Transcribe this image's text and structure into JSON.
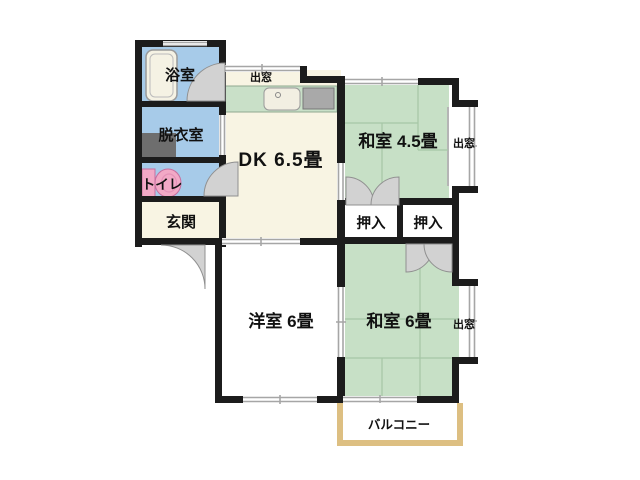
{
  "rooms": {
    "bathroom": {
      "label": "浴室"
    },
    "dressing_room": {
      "label": "脱衣室"
    },
    "toilet": {
      "label": "トイレ"
    },
    "entrance": {
      "label": "玄関"
    },
    "dining_kitchen": {
      "label": "DK 6.5畳"
    },
    "japanese_room_45": {
      "label": "和室 4.5畳"
    },
    "closet_left": {
      "label": "押入"
    },
    "closet_right": {
      "label": "押入"
    },
    "western_room": {
      "label": "洋室 6畳"
    },
    "japanese_room_6": {
      "label": "和室 6畳"
    },
    "balcony": {
      "label": "バルコニー"
    }
  },
  "bay_windows": {
    "top": {
      "label": "出窓"
    },
    "right_upper": {
      "label": "出窓"
    },
    "right_lower": {
      "label": "出窓"
    }
  },
  "colors": {
    "wall": "#1C1C1C",
    "tatami_green": "#C7E0C6",
    "counter_green": "#C9E0C8",
    "water_blue": "#A7CBE9",
    "floor_cream": "#F8F4E3",
    "room_white": "#FFFFFF",
    "balcony_tan": "#DDBF82",
    "step_tan": "#E6CD92",
    "toilet_pink": "#F2A9C6",
    "washer_gray": "#6E6E6E",
    "stove_gray": "#A9A9A9",
    "sink_white": "#F2EFE2",
    "tub_white": "#F5F2E4",
    "door_gray": "#D2D2D2",
    "window_gray": "#A6A6A6",
    "tatami_line": "#A6C6A6"
  }
}
